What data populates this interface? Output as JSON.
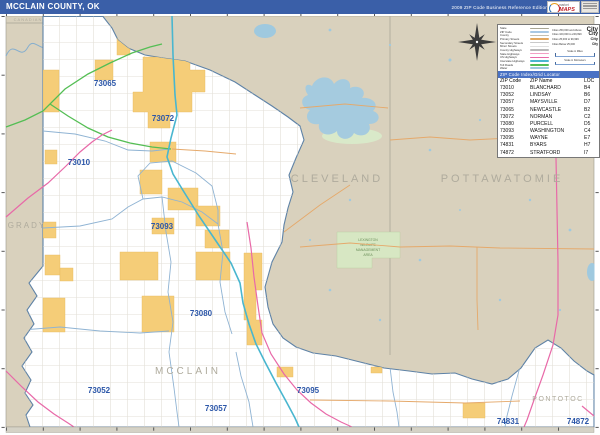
{
  "header": {
    "title": "MCCLAIN COUNTY, OK",
    "edition": "2009 ZIP Code Business Reference Edition",
    "logo": {
      "brand_top": "market",
      "brand": "MAPS"
    }
  },
  "colors": {
    "header_blue": "#3A5FA8",
    "index_bar_blue": "#4A72C4",
    "land_tan": "#D9D1BD",
    "county_white": "#FFFFFF",
    "city_yellow": "#F5CD78",
    "water_blue": "#A5CBDF",
    "zip_label_blue": "#2B56A8",
    "interstate_teal": "#49B6CF",
    "tollroad_green": "#54BE54",
    "us_hwy_pink": "#E869A8"
  },
  "legend": {
    "lines": [
      {
        "label": "State",
        "color": "#A9A694"
      },
      {
        "label": "ZIP Code",
        "color": "#A8C8E4"
      },
      {
        "label": "County",
        "color": "#C4C0B2"
      },
      {
        "label": "Primary Streets",
        "color": "#E3A85F"
      },
      {
        "label": "Secondary Streets",
        "color": "#C9C9C9"
      },
      {
        "label": "Minor Streets",
        "color": "#E0E0E0"
      },
      {
        "label": "County Highways",
        "color": "#B9B9B9"
      },
      {
        "label": "State Highways",
        "color": "#F2A0C4"
      },
      {
        "label": "US Highways",
        "color": "#E869A8"
      },
      {
        "label": "Interstate Highways",
        "color": "#49B6CF"
      },
      {
        "label": "Toll Roads",
        "color": "#54BE54"
      },
      {
        "label": "Water",
        "color": "#9FC9DF"
      }
    ],
    "cities": [
      {
        "label": "Cities 250,000 and Above",
        "sample": "City"
      },
      {
        "label": "Cities 100,000 to 249,999",
        "sample": "City"
      },
      {
        "label": "Cities 25,000 to 99,999",
        "sample": "City"
      },
      {
        "label": "Cities Below 25,000",
        "sample": "City"
      }
    ],
    "scales": [
      {
        "label": "Scale in Miles"
      },
      {
        "label": "Scale in Kilometers"
      }
    ]
  },
  "index": {
    "header_bar": "ZIP Code Index/Grid Locator",
    "columns": [
      "ZIP Code",
      "ZIP Name",
      "LOC"
    ],
    "rows": [
      [
        "73010",
        "BLANCHARD",
        "B4"
      ],
      [
        "73052",
        "LINDSAY",
        "B6"
      ],
      [
        "73057",
        "MAYSVILLE",
        "D7"
      ],
      [
        "73065",
        "NEWCASTLE",
        "B2"
      ],
      [
        "73072",
        "NORMAN",
        "C2"
      ],
      [
        "73080",
        "PURCELL",
        "D5"
      ],
      [
        "73093",
        "WASHINGTON",
        "C4"
      ],
      [
        "73095",
        "WAYNE",
        "E7"
      ],
      [
        "74831",
        "BYARS",
        "H7"
      ],
      [
        "74872",
        "STRATFORD",
        "I7"
      ]
    ]
  },
  "map": {
    "county_labels": [
      {
        "text": "CANADIAN"
      },
      {
        "text": "GRADY"
      },
      {
        "text": "CLEVELAND"
      },
      {
        "text": "POTTAWATOMIE"
      },
      {
        "text": "MCCLAIN"
      },
      {
        "text": "PONTOTOC"
      }
    ],
    "zip_labels": [
      {
        "text": "73065"
      },
      {
        "text": "73072"
      },
      {
        "text": "73010"
      },
      {
        "text": "73093"
      },
      {
        "text": "73080"
      },
      {
        "text": "73052"
      },
      {
        "text": "73057"
      },
      {
        "text": "73095"
      },
      {
        "text": "74831"
      },
      {
        "text": "74872"
      }
    ],
    "wma_label": [
      "LEXINGTON",
      "WILDLIFE",
      "MANAGEMENT",
      "AREA"
    ]
  }
}
